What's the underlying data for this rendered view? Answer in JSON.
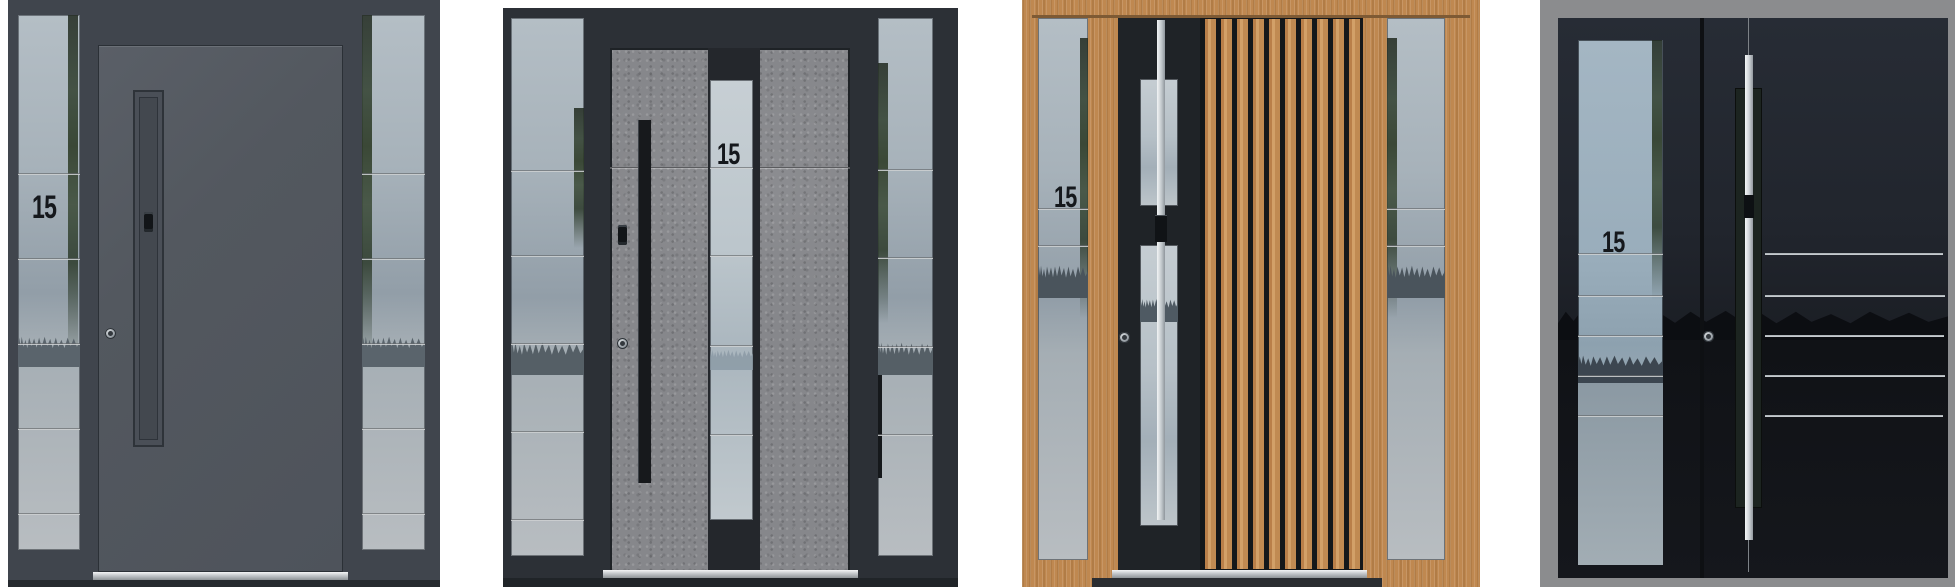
{
  "page": {
    "description": "Product gallery of four modern front entrance door designs with glazed sidelights",
    "background": "#ffffff"
  },
  "theme": {
    "number_color": "#15181c",
    "door1_frame": "#40454d",
    "door1_leaf": "#53585f",
    "door1_glass": "#a9b4bc",
    "door2_frame": "#2c3036",
    "door2_concrete": "#86878b",
    "door2_glass": "#c2ccd2",
    "door3_wood": "#bf8850",
    "door3_panel": "#1f2327",
    "door3_glass": "#c3cdd3",
    "door4_frame": "#8b8c8e",
    "door4_leaf": "#15171c",
    "door4_glass": "#a9bac6",
    "steel": "#d6dadd"
  },
  "doors": [
    {
      "id": "door-1",
      "house_number": "15",
      "style": "anthracite aluminium leaf with recessed vertical pull groove",
      "elements": [
        "electronic-lock-module",
        "cylinder-knob",
        "left-sidelight",
        "right-sidelight",
        "stainless-threshold"
      ],
      "sidelight_glass_panels": 6
    },
    {
      "id": "door-2",
      "house_number": "15",
      "style": "grey concrete-textured leaf with central glazed strip and black bar handle",
      "elements": [
        "fingerprint-reader",
        "cylinder-knob",
        "black-bar-handle",
        "left-sidelight",
        "right-sidelight",
        "stainless-threshold"
      ],
      "center_glass_segments": 5
    },
    {
      "id": "door-3",
      "house_number": "15",
      "style": "oak leaf with vertical timber slats, black glazed column and stainless bar handle",
      "elements": [
        "stainless-bar-handle",
        "cylinder-knob",
        "left-sidelight",
        "right-sidelight",
        "stainless-threshold"
      ],
      "slat_count": 10
    },
    {
      "id": "door-4",
      "house_number": "15",
      "style": "black glass double leaf with stainless bar handle and horizontal inox inlays",
      "elements": [
        "stainless-bar-handle",
        "cylinder-knob",
        "glazed-side-panel",
        "horizontal-steel-lines"
      ],
      "steel_line_count": 5
    }
  ]
}
